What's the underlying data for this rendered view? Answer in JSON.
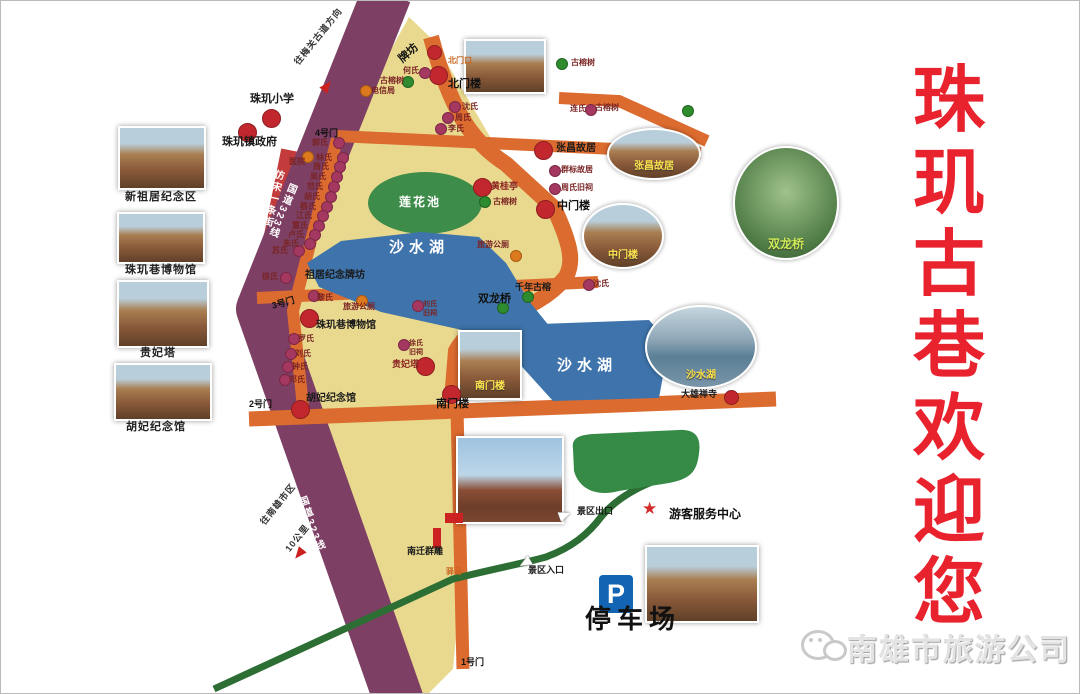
{
  "title": {
    "text": "珠玑古巷欢迎您"
  },
  "footer": {
    "company": "南雄市旅游公司",
    "icon": "wechat-icon"
  },
  "parking": {
    "symbol": "P",
    "label": "停车场"
  },
  "map": {
    "area_names": [
      "莲花池",
      "沙水湖",
      "钓鱼池"
    ],
    "road_names": [
      "国道323线",
      "仿宋一条街"
    ],
    "labels": [
      {
        "t": "珠玑小学",
        "x": 249,
        "y": 93,
        "c": "plg"
      },
      {
        "t": "珠玑镇政府",
        "x": 221,
        "y": 136,
        "c": "plg"
      },
      {
        "t": "新祖居纪念区",
        "x": 124,
        "y": 191,
        "c": "cap"
      },
      {
        "t": "珠玑巷博物馆",
        "x": 124,
        "y": 264,
        "c": "cap"
      },
      {
        "t": "贵妃塔",
        "x": 139,
        "y": 347,
        "c": "cap"
      },
      {
        "t": "胡妃纪念馆",
        "x": 125,
        "y": 421,
        "c": "cap"
      },
      {
        "t": "牌坊",
        "x": 396,
        "y": 56,
        "c": "gate",
        "r": -42
      },
      {
        "t": "北门口",
        "x": 447,
        "y": 56,
        "c": "torg"
      },
      {
        "t": "何氏",
        "x": 402,
        "y": 66,
        "c": "sm"
      },
      {
        "t": "古榕树",
        "x": 379,
        "y": 76,
        "c": "sm"
      },
      {
        "t": "电信局",
        "x": 370,
        "y": 86,
        "c": "sm"
      },
      {
        "t": "北门楼",
        "x": 447,
        "y": 78,
        "c": "gate"
      },
      {
        "t": "沈氏",
        "x": 461,
        "y": 102,
        "c": "sm"
      },
      {
        "t": "周氏",
        "x": 454,
        "y": 113,
        "c": "sm"
      },
      {
        "t": "李氏",
        "x": 447,
        "y": 124,
        "c": "sm"
      },
      {
        "t": "连氏",
        "x": 569,
        "y": 104,
        "c": "sm"
      },
      {
        "t": "古榕树",
        "x": 570,
        "y": 58,
        "c": "sm"
      },
      {
        "t": "古榕树",
        "x": 594,
        "y": 103,
        "c": "sm"
      },
      {
        "t": "张昌故居",
        "x": 555,
        "y": 143,
        "c": "pl"
      },
      {
        "t": "群标故居",
        "x": 560,
        "y": 165,
        "c": "sm"
      },
      {
        "t": "周氏旧祠",
        "x": 560,
        "y": 183,
        "c": "sm"
      },
      {
        "t": "中门楼",
        "x": 556,
        "y": 200,
        "c": "gate"
      },
      {
        "t": "沈氏",
        "x": 592,
        "y": 279,
        "c": "sm"
      },
      {
        "t": "4号门",
        "x": 314,
        "y": 128,
        "c": "gsm"
      },
      {
        "t": "郭氏",
        "x": 311,
        "y": 138,
        "c": "sm"
      },
      {
        "t": "医院",
        "x": 288,
        "y": 157,
        "c": "sm"
      },
      {
        "t": "林氏",
        "x": 315,
        "y": 153,
        "c": "sm"
      },
      {
        "t": "周氏",
        "x": 312,
        "y": 162,
        "c": "sm"
      },
      {
        "t": "吴氏",
        "x": 309,
        "y": 172,
        "c": "sm"
      },
      {
        "t": "范氏",
        "x": 306,
        "y": 182,
        "c": "sm"
      },
      {
        "t": "胡氏",
        "x": 303,
        "y": 192,
        "c": "sm"
      },
      {
        "t": "蔡氏",
        "x": 299,
        "y": 202,
        "c": "sm"
      },
      {
        "t": "江氏",
        "x": 295,
        "y": 211,
        "c": "sm"
      },
      {
        "t": "董氏",
        "x": 291,
        "y": 221,
        "c": "sm"
      },
      {
        "t": "卢氏",
        "x": 287,
        "y": 230,
        "c": "sm"
      },
      {
        "t": "朱氏",
        "x": 282,
        "y": 239,
        "c": "sm"
      },
      {
        "t": "苏氏",
        "x": 271,
        "y": 246,
        "c": "sm"
      },
      {
        "t": "仿宋一条街",
        "x": 272,
        "y": 167,
        "c": "rv",
        "r": 13
      },
      {
        "t": "国道323线",
        "x": 286,
        "y": 180,
        "c": "rv",
        "r": 22
      },
      {
        "t": "国道323线",
        "x": 294,
        "y": 498,
        "c": "rv",
        "r": -20
      },
      {
        "t": "往梅关古道方向",
        "x": 292,
        "y": 60,
        "c": "dir",
        "r": -51
      },
      {
        "t": "往南雄市区",
        "x": 258,
        "y": 520,
        "c": "dir",
        "r": -51
      },
      {
        "t": "10公里",
        "x": 283,
        "y": 547,
        "c": "dir",
        "r": -51
      },
      {
        "t": "祖居纪念牌坊",
        "x": 304,
        "y": 270,
        "c": "pl"
      },
      {
        "t": "3号门",
        "x": 270,
        "y": 301,
        "c": "gsm",
        "r": -15
      },
      {
        "t": "黎氏",
        "x": 316,
        "y": 293,
        "c": "sm"
      },
      {
        "t": "旅游公厕",
        "x": 342,
        "y": 302,
        "c": "sm"
      },
      {
        "t": "珠玑巷博物馆",
        "x": 315,
        "y": 320,
        "c": "pl"
      },
      {
        "t": "罗氏",
        "x": 297,
        "y": 334,
        "c": "sm"
      },
      {
        "t": "刘氏",
        "x": 294,
        "y": 349,
        "c": "sm"
      },
      {
        "t": "钟氏",
        "x": 291,
        "y": 362,
        "c": "sm"
      },
      {
        "t": "邓氏",
        "x": 288,
        "y": 375,
        "c": "sm"
      },
      {
        "t": "徐氏",
        "x": 261,
        "y": 272,
        "c": "sm"
      },
      {
        "t": "2号门",
        "x": 248,
        "y": 399,
        "c": "gsm"
      },
      {
        "t": "胡妃纪念馆",
        "x": 305,
        "y": 393,
        "c": "pl"
      },
      {
        "t": "莲花池",
        "x": 398,
        "y": 195,
        "c": "wsm"
      },
      {
        "t": "沙水湖",
        "x": 388,
        "y": 239,
        "c": "wlk"
      },
      {
        "t": "沙水湖",
        "x": 556,
        "y": 357,
        "c": "wlk"
      },
      {
        "t": "黄桂亭",
        "x": 490,
        "y": 181,
        "c": "dr"
      },
      {
        "t": "古榕树",
        "x": 492,
        "y": 197,
        "c": "sm"
      },
      {
        "t": "旅游公厕",
        "x": 476,
        "y": 240,
        "c": "sm"
      },
      {
        "t": "千年古榕",
        "x": 514,
        "y": 282,
        "c": "psm"
      },
      {
        "t": "双龙桥",
        "x": 477,
        "y": 293,
        "c": "gate"
      },
      {
        "t": "刘氏",
        "x": 422,
        "y": 300,
        "c": "sm7"
      },
      {
        "t": "旧祠",
        "x": 422,
        "y": 309,
        "c": "sm7"
      },
      {
        "t": "徐氏",
        "x": 408,
        "y": 339,
        "c": "sm7"
      },
      {
        "t": "旧祠",
        "x": 408,
        "y": 348,
        "c": "sm7"
      },
      {
        "t": "贵妃塔",
        "x": 391,
        "y": 359,
        "c": "dr"
      },
      {
        "t": "南门楼",
        "x": 435,
        "y": 398,
        "c": "gate"
      },
      {
        "t": "大雄禅寺",
        "x": 680,
        "y": 389,
        "c": "psm"
      },
      {
        "t": "景区出口",
        "x": 576,
        "y": 506,
        "c": "psm"
      },
      {
        "t": "景区入口",
        "x": 527,
        "y": 565,
        "c": "psm"
      },
      {
        "t": "游客服务中心",
        "x": 668,
        "y": 507,
        "c": "svc"
      },
      {
        "t": "南迁群雕",
        "x": 406,
        "y": 546,
        "c": "psm"
      },
      {
        "t": "驿马",
        "x": 445,
        "y": 567,
        "c": "torg"
      },
      {
        "t": "1号门",
        "x": 460,
        "y": 657,
        "c": "gsm"
      }
    ],
    "dots": [
      {
        "x": 270,
        "y": 117,
        "t": "rl"
      },
      {
        "x": 246,
        "y": 131,
        "t": "rl"
      },
      {
        "x": 433,
        "y": 51,
        "t": "r"
      },
      {
        "x": 437,
        "y": 74,
        "t": "rl"
      },
      {
        "x": 423,
        "y": 71,
        "t": "p"
      },
      {
        "x": 406,
        "y": 80,
        "t": "g"
      },
      {
        "x": 364,
        "y": 89,
        "t": "o"
      },
      {
        "x": 453,
        "y": 105,
        "t": "p"
      },
      {
        "x": 446,
        "y": 116,
        "t": "p"
      },
      {
        "x": 439,
        "y": 127,
        "t": "p"
      },
      {
        "x": 589,
        "y": 108,
        "t": "p"
      },
      {
        "x": 560,
        "y": 62,
        "t": "g"
      },
      {
        "x": 686,
        "y": 109,
        "t": "g"
      },
      {
        "x": 542,
        "y": 149,
        "t": "rl"
      },
      {
        "x": 553,
        "y": 169,
        "t": "p"
      },
      {
        "x": 553,
        "y": 187,
        "t": "p"
      },
      {
        "x": 544,
        "y": 208,
        "t": "rl"
      },
      {
        "x": 587,
        "y": 283,
        "t": "p"
      },
      {
        "x": 337,
        "y": 141,
        "t": "p"
      },
      {
        "x": 341,
        "y": 156,
        "t": "p"
      },
      {
        "x": 338,
        "y": 165,
        "t": "p"
      },
      {
        "x": 335,
        "y": 175,
        "t": "p"
      },
      {
        "x": 332,
        "y": 185,
        "t": "p"
      },
      {
        "x": 329,
        "y": 195,
        "t": "p"
      },
      {
        "x": 325,
        "y": 205,
        "t": "p"
      },
      {
        "x": 321,
        "y": 214,
        "t": "p"
      },
      {
        "x": 317,
        "y": 224,
        "t": "p"
      },
      {
        "x": 313,
        "y": 233,
        "t": "p"
      },
      {
        "x": 308,
        "y": 242,
        "t": "p"
      },
      {
        "x": 297,
        "y": 249,
        "t": "p"
      },
      {
        "x": 306,
        "y": 155,
        "t": "o"
      },
      {
        "x": 312,
        "y": 294,
        "t": "p"
      },
      {
        "x": 360,
        "y": 299,
        "t": "o"
      },
      {
        "x": 308,
        "y": 317,
        "t": "rl"
      },
      {
        "x": 292,
        "y": 337,
        "t": "p"
      },
      {
        "x": 289,
        "y": 352,
        "t": "p"
      },
      {
        "x": 286,
        "y": 365,
        "t": "p"
      },
      {
        "x": 283,
        "y": 378,
        "t": "p"
      },
      {
        "x": 284,
        "y": 276,
        "t": "p"
      },
      {
        "x": 416,
        "y": 304,
        "t": "p"
      },
      {
        "x": 402,
        "y": 343,
        "t": "p"
      },
      {
        "x": 424,
        "y": 365,
        "t": "rl"
      },
      {
        "x": 299,
        "y": 408,
        "t": "rl"
      },
      {
        "x": 450,
        "y": 393,
        "t": "rl"
      },
      {
        "x": 481,
        "y": 186,
        "t": "rl"
      },
      {
        "x": 483,
        "y": 200,
        "t": "g"
      },
      {
        "x": 514,
        "y": 254,
        "t": "o"
      },
      {
        "x": 526,
        "y": 295,
        "t": "g"
      },
      {
        "x": 501,
        "y": 306,
        "t": "g"
      },
      {
        "x": 730,
        "y": 396,
        "t": "r"
      },
      {
        "x": 650,
        "y": 508,
        "t": "star"
      },
      {
        "x": 436,
        "y": 529,
        "t": "barv"
      },
      {
        "x": 446,
        "y": 514,
        "t": "barh"
      },
      {
        "x": 558,
        "y": 509,
        "t": "aw",
        "r": -20
      },
      {
        "x": 518,
        "y": 557,
        "t": "aw",
        "r": 150
      },
      {
        "x": 320,
        "y": 80,
        "t": "ar",
        "r": -51
      },
      {
        "x": 292,
        "y": 548,
        "t": "ar",
        "r": 129
      }
    ],
    "photos": [
      {
        "x": 117,
        "y": 125,
        "w": 88,
        "h": 64,
        "s": "rect",
        "tone": "warm"
      },
      {
        "x": 116,
        "y": 211,
        "w": 88,
        "h": 52,
        "s": "rect",
        "tone": "warm"
      },
      {
        "x": 116,
        "y": 279,
        "w": 92,
        "h": 68,
        "s": "rect",
        "tone": "warm"
      },
      {
        "x": 113,
        "y": 362,
        "w": 98,
        "h": 58,
        "s": "rect",
        "tone": "warm"
      },
      {
        "x": 463,
        "y": 38,
        "w": 82,
        "h": 55,
        "s": "rect",
        "tone": "warm"
      },
      {
        "x": 606,
        "y": 127,
        "w": 94,
        "h": 52,
        "s": "ell",
        "cap": "张昌故居",
        "tone": "warm"
      },
      {
        "x": 581,
        "y": 202,
        "w": 82,
        "h": 66,
        "s": "ell",
        "cap": "中门楼",
        "tone": "warm"
      },
      {
        "x": 732,
        "y": 145,
        "w": 106,
        "h": 114,
        "s": "ell",
        "cap": "双龙桥",
        "cc": "lime",
        "tone": "green"
      },
      {
        "x": 644,
        "y": 304,
        "w": 112,
        "h": 84,
        "s": "ell",
        "cap": "沙水湖",
        "tone": "water"
      },
      {
        "x": 455,
        "y": 435,
        "w": 108,
        "h": 88,
        "s": "rect",
        "tone": "sky"
      },
      {
        "x": 457,
        "y": 329,
        "w": 64,
        "h": 70,
        "s": "rect",
        "cap": "南门楼",
        "tone": "warm"
      },
      {
        "x": 644,
        "y": 544,
        "w": 114,
        "h": 78,
        "s": "rect",
        "tone": "warm"
      }
    ]
  }
}
